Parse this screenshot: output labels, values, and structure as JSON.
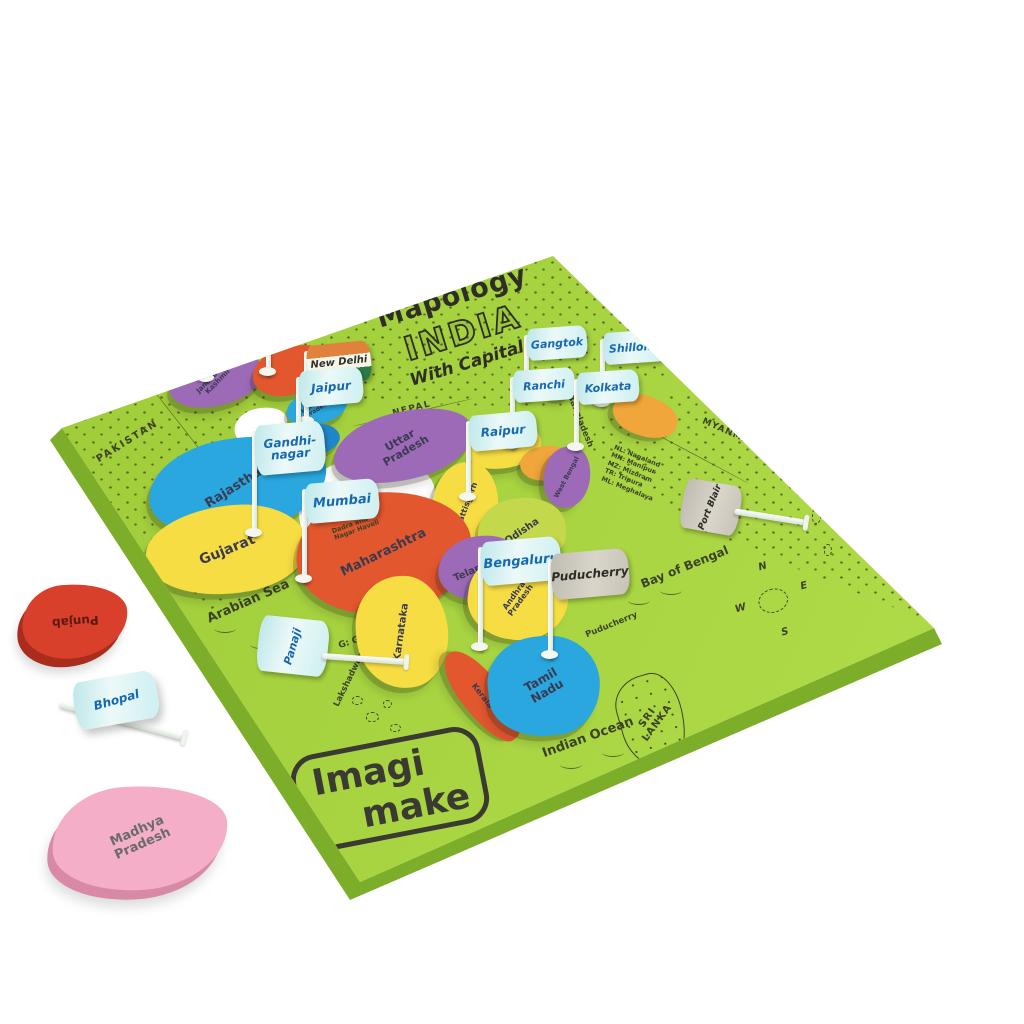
{
  "product": {
    "series": "Mapology",
    "title": "INDIA",
    "subtitle": "With Capitals",
    "brand_top": "Imagi",
    "brand_bottom": "make"
  },
  "board_labels": {
    "afghanistan": "AFGHANISTAN",
    "pakistan": "PAKISTAN",
    "nepal": "NEPAL",
    "myanmar": "MYANMAR",
    "bangladesh": "Bangladesh",
    "arabian_sea": "Arabian Sea",
    "bay_of_bengal": "Bay of Bengal",
    "indian_ocean": "Indian Ocean",
    "sri_lanka": "SRI LANKA",
    "lakshadweep": "Lakshadweep",
    "andaman_nicobar": "Andaman and Nicobar Islands",
    "daman_and_diu": "Daman and Diu",
    "goa_note": "G: Goa",
    "puducherry": "Puducherry",
    "dadra_nagar_haveli": "Dadra and Nagar Haveli",
    "ne_states_note": [
      "NL: Nagaland",
      "MN: Manipur",
      "MZ: Mizoram",
      "TR: Tripura",
      "ML: Meghalaya"
    ]
  },
  "compass": {
    "n": "N",
    "e": "E",
    "s": "S",
    "w": "W"
  },
  "states": [
    {
      "name": "jammu-kashmir",
      "label": "Jammu and Kashmir",
      "color": "#9d6ab8"
    },
    {
      "name": "ladakh",
      "label": "",
      "color": "#e2572e"
    },
    {
      "name": "himachal-pradesh",
      "label": "Himachal Pradesh",
      "color": "#29a7de"
    },
    {
      "name": "haryana",
      "label": "",
      "color": "#1f86c9"
    },
    {
      "name": "rajasthan",
      "label": "Rajasthan",
      "color": "#29a7de"
    },
    {
      "name": "uttar-pradesh",
      "label": "Uttar Pradesh",
      "color": "#9d6ab8"
    },
    {
      "name": "gujarat",
      "label": "Gujarat",
      "color": "#f6dd43"
    },
    {
      "name": "bihar",
      "label": "",
      "color": "#f6dd43"
    },
    {
      "name": "jharkhand",
      "label": "",
      "color": "#f0a63a"
    },
    {
      "name": "west-bengal",
      "label": "West Bengal",
      "color": "#9d6ab8"
    },
    {
      "name": "sikkim",
      "label": "",
      "color": "#29a7de"
    },
    {
      "name": "northeast-states",
      "label": "",
      "color": "#f0a63a"
    },
    {
      "name": "chhattisgarh",
      "label": "Chhattisgarh",
      "color": "#f6dd43"
    },
    {
      "name": "odisha",
      "label": "Odisha",
      "color": "#c3d94b"
    },
    {
      "name": "maharashtra",
      "label": "Maharashtra",
      "color": "#e2572e"
    },
    {
      "name": "telangana",
      "label": "Telangana",
      "color": "#9d6ab8"
    },
    {
      "name": "andhra-pradesh",
      "label": "Andhra Pradesh",
      "color": "#f6dd43"
    },
    {
      "name": "karnataka",
      "label": "Karnataka",
      "color": "#f6dd43"
    },
    {
      "name": "kerala",
      "label": "Kerala",
      "color": "#e2572e"
    },
    {
      "name": "tamil-nadu",
      "label": "Tamil Nadu",
      "color": "#29a7de"
    }
  ],
  "flags": [
    {
      "capital": "Srinagar",
      "flag_color": "gray"
    },
    {
      "capital": "Leh",
      "flag_color": "gray"
    },
    {
      "capital": "New Delhi",
      "flag_color": "tricolor"
    },
    {
      "capital": "Jaipur",
      "flag_color": "light-blue"
    },
    {
      "capital": "Gandhi- nagar",
      "flag_color": "light-blue"
    },
    {
      "capital": "Mumbai",
      "flag_color": "light-blue"
    },
    {
      "capital": "Gangtok",
      "flag_color": "light-blue"
    },
    {
      "capital": "Shillong",
      "flag_color": "light-blue"
    },
    {
      "capital": "Ranchi",
      "flag_color": "light-blue"
    },
    {
      "capital": "Kolkata",
      "flag_color": "light-blue"
    },
    {
      "capital": "Raipur",
      "flag_color": "light-blue"
    },
    {
      "capital": "Bengaluru",
      "flag_color": "light-blue"
    },
    {
      "capital": "Puducherry",
      "flag_color": "gray"
    },
    {
      "capital": "Port Blair",
      "flag_color": "gray"
    },
    {
      "capital": "Panaji",
      "flag_color": "light-blue"
    }
  ],
  "loose_pieces": {
    "punjab": {
      "label": "Punjab",
      "color": "#d8402c"
    },
    "madhya_pradesh": {
      "label": "Madhya Pradesh",
      "color": "#f5aec7"
    },
    "bhopal_flag": {
      "label": "Bhopal",
      "color": "#cdeef2"
    }
  },
  "colors": {
    "board": "#a7d23e",
    "board_edge": "#7dae2a",
    "flag_light_blue": "#cdeef2",
    "flag_text_blue": "#1668b3",
    "flag_gray": "#c7c3b8"
  }
}
